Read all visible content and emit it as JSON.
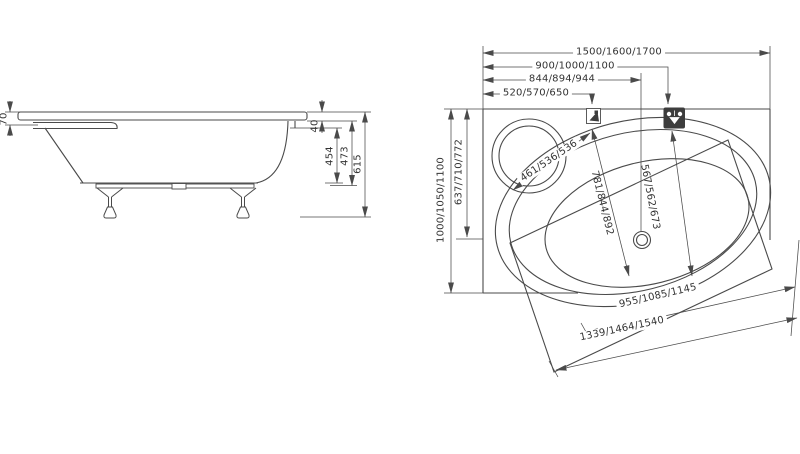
{
  "side": {
    "dims": [
      "70",
      "40",
      "454",
      "473",
      "615"
    ]
  },
  "plan": {
    "top_dims": [
      "1500/1600/1700",
      "900/1000/1100",
      "844/894/944",
      "520/570/650"
    ],
    "left_dims": [
      "1000/1050/1100",
      "637/710/772"
    ],
    "inner_dims": [
      "461/536/536",
      "781/844/892",
      "567/562/673"
    ],
    "bottom_dims": [
      "955/1085/1145",
      "1339/1464/1540"
    ],
    "icons": [
      "handshower-icon",
      "mixer-tap-icon"
    ]
  },
  "colors": {
    "line": "#4a4a4a",
    "text": "#333333",
    "background": "#ffffff"
  }
}
